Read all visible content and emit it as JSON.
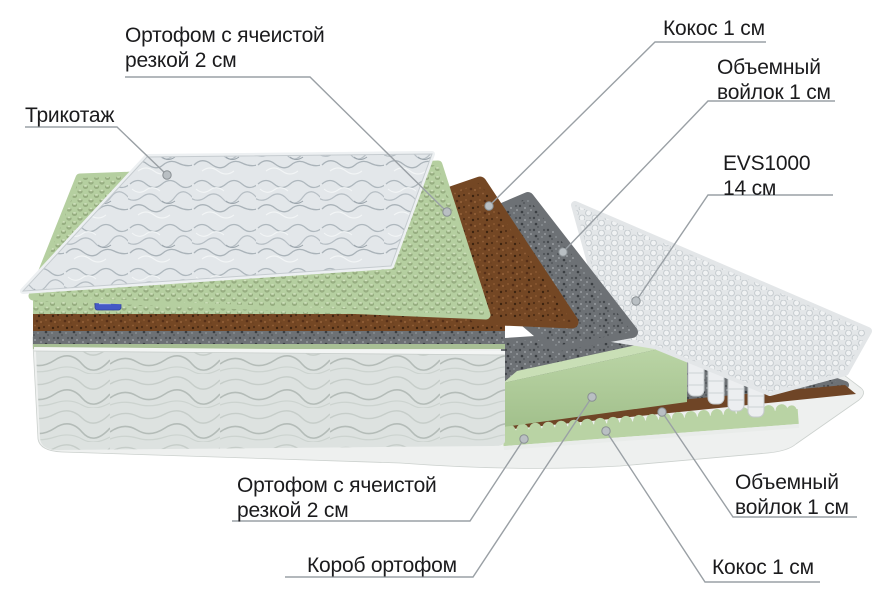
{
  "diagram": {
    "labels": {
      "orthofoam_top": {
        "line1": "Ортофом с ячеистой",
        "line2": "резкой 2 см"
      },
      "knit": {
        "line1": "Трикотаж",
        "line2": ""
      },
      "coconut_top": {
        "line1": "Кокос 1 см",
        "line2": ""
      },
      "felt_top": {
        "line1": "Объемный",
        "line2": "войлок 1 см"
      },
      "springs": {
        "line1": "EVS1000",
        "line2": "14 см"
      },
      "orthofoam_bottom": {
        "line1": "Ортофом с ячеистой",
        "line2": "резкой 2 см"
      },
      "box": {
        "line1": "Короб ортофом",
        "line2": ""
      },
      "felt_bottom": {
        "line1": "Объемный",
        "line2": "войлок 1 см"
      },
      "coconut_bottom": {
        "line1": "Кокос 1 см",
        "line2": ""
      }
    },
    "colors": {
      "background": "#ffffff",
      "text": "#1b1b1d",
      "leader_line": "#9aa0a5",
      "foam_green": "#b5cfa0",
      "coir_brown": "#744724",
      "felt_gray": "#6d7175",
      "spring_white": "#e9eced",
      "quilt_white": "#e2e6e9",
      "tag_blue": "#4459c6"
    }
  }
}
